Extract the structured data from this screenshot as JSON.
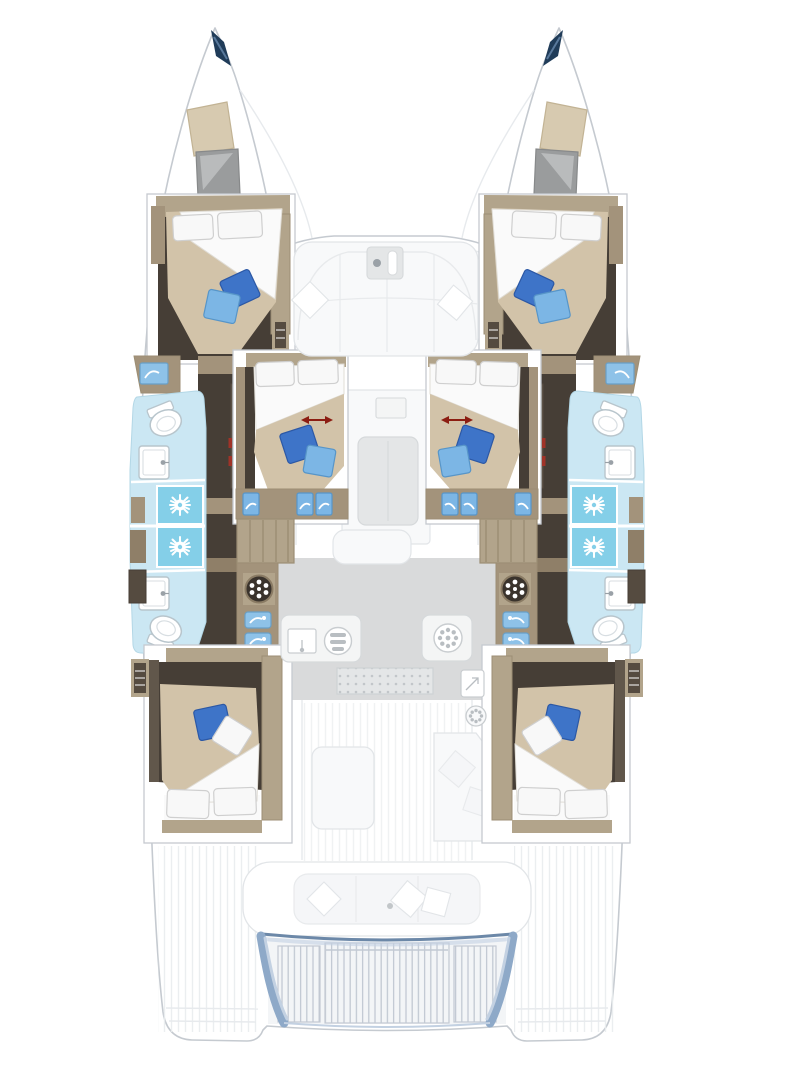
{
  "diagram": {
    "kind": "catamaran-yacht-interior-floor-plan",
    "view": "top-down deck layout, bow at top, stern at bottom",
    "title": "Catamaran 6-cabin interior layout plan",
    "hulls": 2,
    "cabins_with_double_beds": 6,
    "cabin_positions": [
      "forward-port",
      "forward-starboard",
      "mid-port",
      "mid-starboard",
      "aft-port",
      "aft-starboard"
    ],
    "bathrooms": 4,
    "showers": 4,
    "toilets": 4,
    "sinks": 4,
    "convertible_berth_arrows": 2,
    "elements": [
      "bow-tip",
      "bow-skylight",
      "bow-hatch",
      "double-bed",
      "white-pillow",
      "blue-pillow",
      "bathroom",
      "shower",
      "toilet",
      "washbasin",
      "vanity-sink",
      "corridor",
      "stairs",
      "galley-counter",
      "stove-burner",
      "galley-sink",
      "entry-mat",
      "icebox",
      "foredeck-sofa",
      "salon-table",
      "salon-bench",
      "cockpit-table",
      "cockpit-sofa",
      "aft-bench",
      "swim-platform",
      "stern-deck"
    ]
  },
  "palette": {
    "hull_fill": "#ffffff",
    "hull_outline": "#c5cad0",
    "faint_line": "#e7eaed",
    "deck_stripe": "#e9ecee",
    "wood": "#b2a48b",
    "wood_dark": "#9c8e74",
    "wood_mid": "#a3937b",
    "wood_deep": "#8f7f68",
    "espresso": "#463e36",
    "door_panel": "#61574b",
    "locker_dark": "#554b40",
    "bed_beige": "#d2c3a9",
    "bed_white": "#fafafa",
    "bed_white_stroke": "#e0ddd6",
    "pillow_white": "#f8f8f8",
    "pillow_stroke": "#cfcfcf",
    "royal_blue": "#3e74c8",
    "royal_stroke": "#2c58a5",
    "sky_blue": "#7cb6e5",
    "sky_stroke": "#5795c8",
    "bath_floor": "#cbe7f3",
    "bath_stroke": "#b3d7e6",
    "shower_tile": "#84cfe8",
    "fixture_white": "#ffffff",
    "fixture_stroke": "#b8c5cc",
    "fixture_inner": "#d8dee2",
    "vanity_blue": "#8ec2e8",
    "vanity_blue_stroke": "#699fc6",
    "red_arrow": "#8c1d12",
    "red_hinge": "#a03328",
    "navy_tip": "#203c59",
    "navy_accent": "#59799c",
    "skylight_tan": "#d7cab0",
    "skylight_stroke": "#c2b394",
    "hatch_gray": "#9a9c9d",
    "hatch_sheen": "#b9bbbc",
    "hatch_stroke": "#87898a",
    "galley_floor": "#d9dadb",
    "counter_white": "#f4f5f5",
    "counter_stroke": "#d6d9db",
    "appliance_stroke": "#c9cdd0",
    "appliance_dot": "#b9bec2",
    "burner_dark": "#3a332c",
    "burner_ring": "#8a7b64",
    "mat_fill": "#e4e6e7",
    "mat_dot": "#c2c6c9",
    "mat_stroke": "#ced2d4",
    "soft_white": "#f8f9fa",
    "soft_stroke": "#e2e5e8",
    "softer_stroke": "#e8eaec",
    "bench_fill": "#f5f6f8",
    "platform_edge": "#8ea9c8",
    "platform_edge_dark": "#6c88a8",
    "platform_edge_light": "#c3d1e2",
    "slat_line": "#c2c9d3",
    "slat_fill": "#f3f5f7",
    "gray_dot": "#9aa1a7",
    "white": "#ffffff"
  }
}
